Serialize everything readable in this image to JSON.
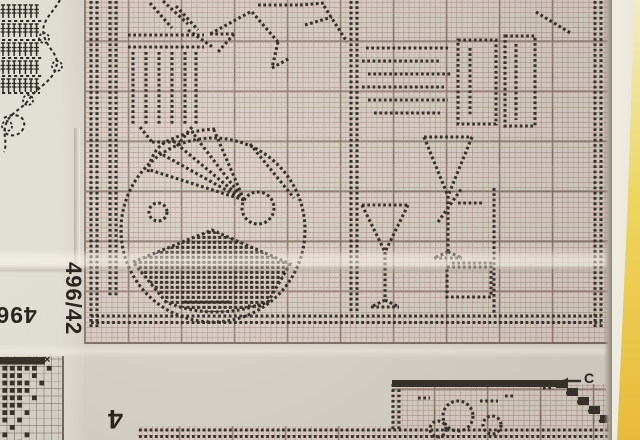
{
  "labels": {
    "chart_number_side": "496/42",
    "chart_number_bottom_partial": "496/",
    "chart_number_corner_partial": "4",
    "marker_c": "C",
    "x_mark": "×"
  },
  "colors": {
    "paper": "#d7d2c8",
    "margin_paper": "#e6e3d9",
    "grid_paper": "#d9cec5",
    "fine_line": "#967c72",
    "heavy_line": "#6c584e",
    "dot": "#37312b",
    "symbol_ink": "#2e2b26",
    "edge_strip_yellow": "#e9ba3a",
    "edge_strip_cream": "#efece1"
  },
  "artwork": {
    "shapes": [
      {
        "t": "dline",
        "x1": 91,
        "y1": 1,
        "x2": 91,
        "y2": 327
      },
      {
        "t": "dline",
        "x1": 97,
        "y1": 1,
        "x2": 97,
        "y2": 327
      },
      {
        "t": "dline",
        "x1": 595,
        "y1": 1,
        "x2": 595,
        "y2": 327
      },
      {
        "t": "dline",
        "x1": 601,
        "y1": 1,
        "x2": 601,
        "y2": 327
      },
      {
        "t": "dline",
        "x1": 91,
        "y1": 316,
        "x2": 601,
        "y2": 316
      },
      {
        "t": "dline",
        "x1": 91,
        "y1": 322.5,
        "x2": 601,
        "y2": 322.5
      },
      {
        "t": "dline",
        "x1": 110,
        "y1": 1,
        "x2": 110,
        "y2": 296
      },
      {
        "t": "dline",
        "x1": 116,
        "y1": 1,
        "x2": 116,
        "y2": 296
      },
      {
        "t": "dline",
        "x1": 128,
        "y1": 35,
        "x2": 204,
        "y2": 35
      },
      {
        "t": "dline",
        "x1": 128,
        "y1": 47,
        "x2": 204,
        "y2": 47
      },
      {
        "t": "dline",
        "x1": 133,
        "y1": 52,
        "x2": 133,
        "y2": 125
      },
      {
        "t": "dline",
        "x1": 146,
        "y1": 52,
        "x2": 146,
        "y2": 125
      },
      {
        "t": "dline",
        "x1": 159,
        "y1": 52,
        "x2": 159,
        "y2": 125
      },
      {
        "t": "dline",
        "x1": 172,
        "y1": 52,
        "x2": 172,
        "y2": 125
      },
      {
        "t": "dline",
        "x1": 185,
        "y1": 52,
        "x2": 185,
        "y2": 125
      },
      {
        "t": "dline",
        "x1": 196,
        "y1": 52,
        "x2": 196,
        "y2": 125
      },
      {
        "t": "dline",
        "x1": 140,
        "y1": 127,
        "x2": 152,
        "y2": 142
      },
      {
        "t": "dline",
        "x1": 192,
        "y1": 127,
        "x2": 180,
        "y2": 142
      },
      {
        "t": "dline",
        "x1": 152,
        "y1": 142,
        "x2": 180,
        "y2": 142
      },
      {
        "t": "dline",
        "x1": 150,
        "y1": 3,
        "x2": 172,
        "y2": 28
      },
      {
        "t": "dline",
        "x1": 163,
        "y1": 1,
        "x2": 188,
        "y2": 24
      },
      {
        "t": "dline",
        "x1": 176,
        "y1": 6,
        "x2": 198,
        "y2": 30
      },
      {
        "t": "dline",
        "x1": 188,
        "y1": 30,
        "x2": 214,
        "y2": 48
      },
      {
        "t": "dline",
        "x1": 250,
        "y1": 12,
        "x2": 210,
        "y2": 34
      },
      {
        "t": "dline",
        "x1": 210,
        "y1": 34,
        "x2": 234,
        "y2": 34
      },
      {
        "t": "dline",
        "x1": 234,
        "y1": 34,
        "x2": 218,
        "y2": 52
      },
      {
        "t": "dline",
        "x1": 252,
        "y1": 12,
        "x2": 278,
        "y2": 42
      },
      {
        "t": "dline",
        "x1": 278,
        "y1": 42,
        "x2": 272,
        "y2": 68
      },
      {
        "t": "dline",
        "x1": 272,
        "y1": 68,
        "x2": 290,
        "y2": 58
      },
      {
        "t": "dline",
        "x1": 258,
        "y1": 5,
        "x2": 298,
        "y2": 5
      },
      {
        "t": "dline",
        "x1": 300,
        "y1": 5,
        "x2": 324,
        "y2": 3
      },
      {
        "t": "dline",
        "x1": 305,
        "y1": 25,
        "x2": 332,
        "y2": 17
      },
      {
        "t": "dline",
        "x1": 324,
        "y1": 6,
        "x2": 347,
        "y2": 42
      },
      {
        "t": "dline",
        "x1": 351,
        "y1": 1,
        "x2": 351,
        "y2": 313
      },
      {
        "t": "dline",
        "x1": 357,
        "y1": 1,
        "x2": 357,
        "y2": 313
      },
      {
        "t": "dline",
        "x1": 366,
        "y1": 48,
        "x2": 448,
        "y2": 48
      },
      {
        "t": "dline",
        "x1": 362,
        "y1": 61,
        "x2": 440,
        "y2": 61
      },
      {
        "t": "dline",
        "x1": 368,
        "y1": 74,
        "x2": 452,
        "y2": 74
      },
      {
        "t": "dline",
        "x1": 362,
        "y1": 87,
        "x2": 444,
        "y2": 87
      },
      {
        "t": "dline",
        "x1": 368,
        "y1": 100,
        "x2": 448,
        "y2": 100
      },
      {
        "t": "dline",
        "x1": 374,
        "y1": 113,
        "x2": 440,
        "y2": 113
      },
      {
        "t": "drect",
        "x": 458,
        "y": 40,
        "w": 38,
        "h": 84
      },
      {
        "t": "drect",
        "x": 505,
        "y": 36,
        "w": 30,
        "h": 90
      },
      {
        "t": "dline",
        "x1": 470,
        "y1": 48,
        "x2": 470,
        "y2": 116
      },
      {
        "t": "dline",
        "x1": 516,
        "y1": 44,
        "x2": 516,
        "y2": 120
      },
      {
        "t": "dline",
        "x1": 536,
        "y1": 12,
        "x2": 572,
        "y2": 34
      },
      {
        "t": "dcircle",
        "cx": 213,
        "cy": 230,
        "r": 92
      },
      {
        "t": "dline",
        "x1": 244,
        "y1": 200,
        "x2": 150,
        "y2": 170
      },
      {
        "t": "dline",
        "x1": 244,
        "y1": 200,
        "x2": 158,
        "y2": 152
      },
      {
        "t": "dline",
        "x1": 244,
        "y1": 200,
        "x2": 172,
        "y2": 140
      },
      {
        "t": "dline",
        "x1": 244,
        "y1": 200,
        "x2": 192,
        "y2": 132
      },
      {
        "t": "dline",
        "x1": 244,
        "y1": 200,
        "x2": 214,
        "y2": 130
      },
      {
        "t": "dpath",
        "d": "M148,172 Q152,146 172,139 Q192,130 216,129"
      },
      {
        "t": "dcircle",
        "cx": 258,
        "cy": 208,
        "r": 16
      },
      {
        "t": "dline",
        "x1": 250,
        "y1": 144,
        "x2": 294,
        "y2": 198
      },
      {
        "t": "dotfill",
        "d": "M133,262 L212,230 L290,264 L268,302 Q214,322 166,302 Z"
      },
      {
        "t": "dcircle",
        "cx": 158,
        "cy": 212,
        "r": 9
      },
      {
        "t": "dline",
        "x1": 494,
        "y1": 188,
        "x2": 494,
        "y2": 314
      },
      {
        "t": "dline",
        "x1": 452,
        "y1": 263,
        "x2": 492,
        "y2": 263
      },
      {
        "t": "drect",
        "x": 447,
        "y": 267,
        "w": 44,
        "h": 30
      },
      {
        "t": "dline",
        "x1": 458,
        "y1": 203,
        "x2": 484,
        "y2": 203
      },
      {
        "t": "dline",
        "x1": 438,
        "y1": 222,
        "x2": 462,
        "y2": 188
      },
      {
        "t": "dline",
        "x1": 424,
        "y1": 137,
        "x2": 472,
        "y2": 137
      },
      {
        "t": "dline",
        "x1": 424,
        "y1": 137,
        "x2": 448,
        "y2": 196
      },
      {
        "t": "dline",
        "x1": 472,
        "y1": 137,
        "x2": 448,
        "y2": 196
      },
      {
        "t": "dline",
        "x1": 448,
        "y1": 196,
        "x2": 448,
        "y2": 252
      },
      {
        "t": "dline",
        "x1": 448,
        "y1": 252,
        "x2": 434,
        "y2": 258
      },
      {
        "t": "dline",
        "x1": 448,
        "y1": 252,
        "x2": 462,
        "y2": 258
      },
      {
        "t": "dline",
        "x1": 434,
        "y1": 258,
        "x2": 462,
        "y2": 258
      },
      {
        "t": "dline",
        "x1": 362,
        "y1": 205,
        "x2": 408,
        "y2": 205
      },
      {
        "t": "dline",
        "x1": 362,
        "y1": 205,
        "x2": 385,
        "y2": 252
      },
      {
        "t": "dline",
        "x1": 408,
        "y1": 205,
        "x2": 385,
        "y2": 252
      },
      {
        "t": "dline",
        "x1": 385,
        "y1": 252,
        "x2": 385,
        "y2": 300
      },
      {
        "t": "dline",
        "x1": 385,
        "y1": 300,
        "x2": 371,
        "y2": 307
      },
      {
        "t": "dline",
        "x1": 385,
        "y1": 300,
        "x2": 399,
        "y2": 307
      },
      {
        "t": "dline",
        "x1": 371,
        "y1": 307,
        "x2": 399,
        "y2": 307
      },
      {
        "t": "dline",
        "x1": 184,
        "y1": 302,
        "x2": 232,
        "y2": 302
      },
      {
        "t": "dline",
        "x1": 248,
        "y1": 306,
        "x2": 262,
        "y2": 306
      },
      {
        "t": "dcrow",
        "x": 3,
        "y": 5,
        "count": 7,
        "step": 5.6
      },
      {
        "t": "dcrow",
        "x": 3,
        "y": 24,
        "count": 7,
        "step": 5.6
      },
      {
        "t": "dcrow",
        "x": 3,
        "y": 43,
        "count": 7,
        "step": 5.6
      },
      {
        "t": "dcrow",
        "x": 3,
        "y": 61,
        "count": 7,
        "step": 5.6
      },
      {
        "t": "dcrow",
        "x": 3,
        "y": 79,
        "count": 7,
        "step": 5.6
      },
      {
        "t": "dashline",
        "x1": 2,
        "y1": 21,
        "x2": 42,
        "y2": 21
      },
      {
        "t": "dashline",
        "x1": 2,
        "y1": 40,
        "x2": 42,
        "y2": 40
      },
      {
        "t": "dashline",
        "x1": 2,
        "y1": 58,
        "x2": 42,
        "y2": 58
      },
      {
        "t": "dashline",
        "x1": 2,
        "y1": 76,
        "x2": 42,
        "y2": 76
      },
      {
        "t": "dashline",
        "x1": 2,
        "y1": 93,
        "x2": 40,
        "y2": 93
      },
      {
        "t": "dashpath",
        "d": "M60,0 C52,14 40,22 44,36 C48,50 60,54 56,68 C52,82 36,88 30,98 C22,110 10,112 6,124 C2,134 8,142 4,152"
      },
      {
        "t": "dashpath",
        "d": "M4,118 C14,112 26,116 24,126 C22,136 10,138 4,132"
      },
      {
        "t": "dashcircle",
        "cx": 44,
        "cy": 38,
        "r": 5
      },
      {
        "t": "dashcircle",
        "cx": 57,
        "cy": 66,
        "r": 5
      },
      {
        "t": "dashcircle",
        "cx": 28,
        "cy": 100,
        "r": 5
      },
      {
        "t": "dashcircle",
        "cx": 7,
        "cy": 126,
        "r": 5
      },
      {
        "t": "solid",
        "x": 392,
        "y": 380,
        "w": 164,
        "h": 7
      },
      {
        "t": "solid",
        "x": 556,
        "y": 380,
        "w": 12,
        "h": 8
      },
      {
        "t": "solid",
        "x": 567,
        "y": 388,
        "w": 11,
        "h": 8
      },
      {
        "t": "solid",
        "x": 578,
        "y": 397,
        "w": 11,
        "h": 8
      },
      {
        "t": "solid",
        "x": 589,
        "y": 406,
        "w": 11,
        "h": 8
      },
      {
        "t": "solid",
        "x": 600,
        "y": 415,
        "w": 11,
        "h": 8
      },
      {
        "t": "solid",
        "x": 607,
        "y": 424,
        "w": 9,
        "h": 8
      },
      {
        "t": "dline",
        "x1": 566,
        "y1": 393,
        "x2": 572,
        "y2": 393
      },
      {
        "t": "dline",
        "x1": 577,
        "y1": 402,
        "x2": 583,
        "y2": 402
      },
      {
        "t": "dline",
        "x1": 588,
        "y1": 411,
        "x2": 594,
        "y2": 411
      },
      {
        "t": "dline",
        "x1": 599,
        "y1": 421,
        "x2": 605,
        "y2": 421
      },
      {
        "t": "dline",
        "x1": 393,
        "y1": 384,
        "x2": 393,
        "y2": 430
      },
      {
        "t": "dline",
        "x1": 399,
        "y1": 384,
        "x2": 399,
        "y2": 430
      },
      {
        "t": "dline",
        "x1": 139,
        "y1": 430,
        "x2": 612,
        "y2": 430
      },
      {
        "t": "dline",
        "x1": 139,
        "y1": 436.5,
        "x2": 612,
        "y2": 436.5
      },
      {
        "t": "dline",
        "x1": 611,
        "y1": 390,
        "x2": 611,
        "y2": 424
      },
      {
        "t": "dcircle",
        "cx": 458,
        "cy": 416,
        "r": 15
      },
      {
        "t": "dcircle",
        "cx": 438,
        "cy": 429,
        "r": 8
      },
      {
        "t": "dcircle",
        "cx": 492,
        "cy": 425,
        "r": 9
      },
      {
        "t": "dline",
        "x1": 480,
        "y1": 401,
        "x2": 498,
        "y2": 401
      },
      {
        "t": "dline",
        "x1": 505,
        "y1": 396,
        "x2": 514,
        "y2": 396
      },
      {
        "t": "dline",
        "x1": 418,
        "y1": 398,
        "x2": 430,
        "y2": 398
      },
      {
        "t": "dline",
        "x1": 543,
        "y1": 388,
        "x2": 551,
        "y2": 388
      },
      {
        "t": "arrow",
        "x1": 581,
        "y1": 381,
        "x2": 562,
        "y2": 381
      }
    ],
    "corner_chart": {
      "origin_x": 1,
      "origin_y": 357,
      "cell": 7.4,
      "bar": {
        "x": 0,
        "y": 357,
        "w": 45,
        "h": 7.5
      },
      "cells": [
        [
          0,
          1
        ],
        [
          1,
          1
        ],
        [
          2,
          1
        ],
        [
          3,
          1
        ],
        [
          4,
          1
        ],
        [
          6,
          1
        ],
        [
          0,
          2
        ],
        [
          1,
          2
        ],
        [
          2,
          2
        ],
        [
          4,
          2
        ],
        [
          0,
          3
        ],
        [
          1,
          3
        ],
        [
          2,
          3
        ],
        [
          3,
          3
        ],
        [
          5,
          3
        ],
        [
          0,
          4
        ],
        [
          1,
          4
        ],
        [
          2,
          4
        ],
        [
          3,
          4
        ],
        [
          0,
          5
        ],
        [
          1,
          5
        ],
        [
          2,
          5
        ],
        [
          4,
          5
        ],
        [
          0,
          6
        ],
        [
          1,
          6
        ],
        [
          2,
          6
        ],
        [
          0,
          7
        ],
        [
          1,
          7
        ],
        [
          3,
          7
        ],
        [
          0,
          8
        ],
        [
          2,
          8
        ],
        [
          1,
          9
        ],
        [
          0,
          10
        ],
        [
          3,
          10
        ],
        [
          2,
          11
        ]
      ]
    }
  }
}
